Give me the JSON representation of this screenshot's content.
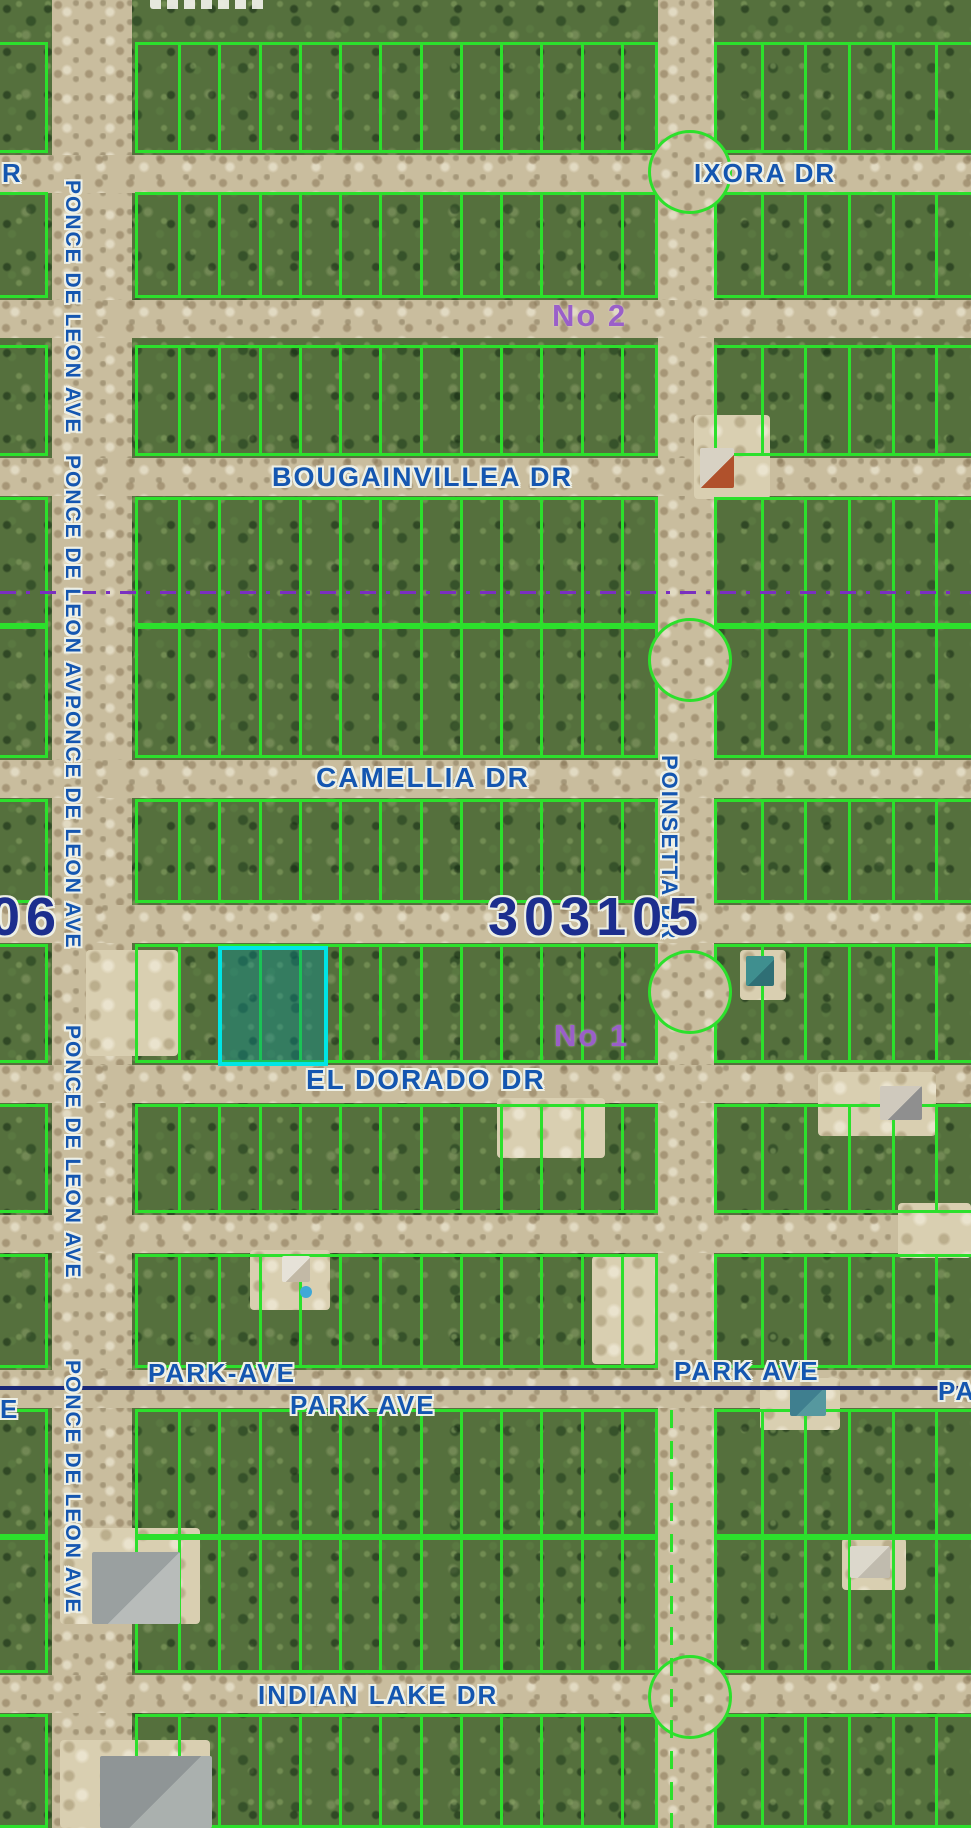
{
  "map": {
    "section_numbers": {
      "main": "303105",
      "left_clipped": "06"
    },
    "unit_labels": {
      "no1": "No 1",
      "no2": "No 2"
    },
    "streets": {
      "ixora": "IXORA DR",
      "bougainvillea": "BOUGAINVILLEA DR",
      "camellia": "CAMELLIA DR",
      "el_dorado": "EL DORADO DR",
      "park_left": "PARK-AVE",
      "park_center": "PARK AVE",
      "park_right": "PARK AVE",
      "park_right_clipped": "PA",
      "indian_lake": "INDIAN LAKE DR",
      "ponce": "PONCE DE LEON AVE",
      "poinsetta": "POINSETTA DR",
      "left_clipped_dr": "R",
      "left_clipped_ave": "E"
    },
    "colors": {
      "parcel_line_green": "#2ce02c",
      "highlight_parcel_border": "#00e5e5",
      "highlight_parcel_fill": "rgba(0,145,155,0.38)",
      "street_label_blue": "#1456b0",
      "section_number_navy": "#1c2e8e",
      "unit_label_purple": "#9a5fc9",
      "boundary_dashed_purple": "#7a2fc0",
      "park_ave_line_navy": "#1a2878",
      "road_tan": "#c9bd9e"
    }
  }
}
